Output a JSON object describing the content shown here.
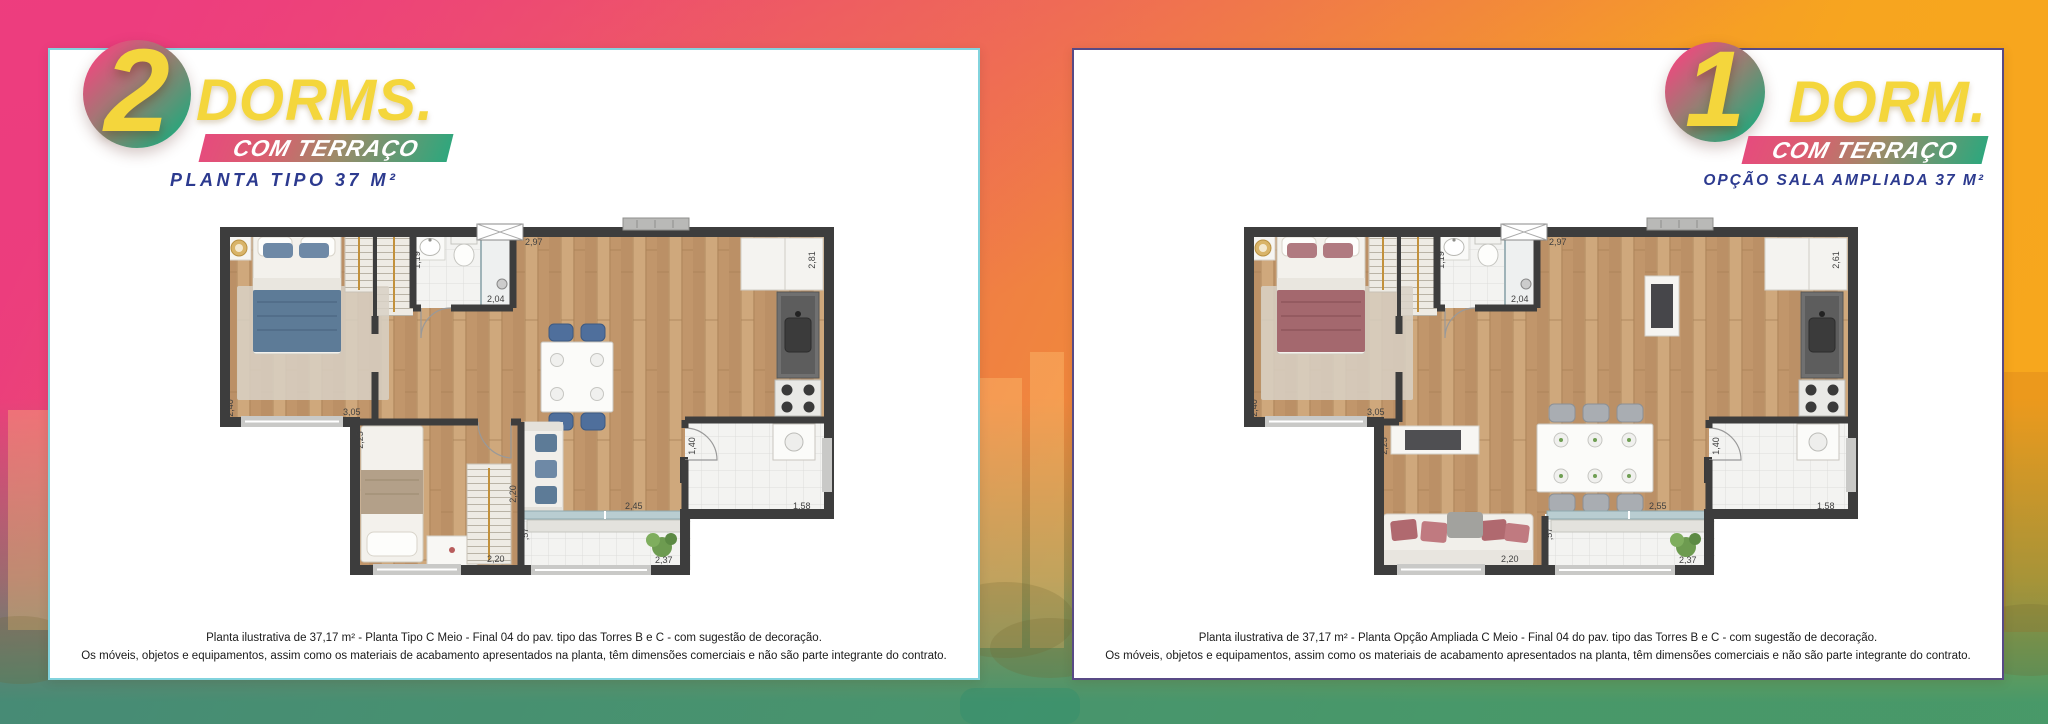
{
  "colors": {
    "accent_pink": "#ee3d7f",
    "accent_orange": "#f7a51f",
    "accent_green": "#2ea77d",
    "accent_yellow": "#f4d63c",
    "navy": "#2c3a8f",
    "card_border_left": "#82d3dd",
    "card_border_right": "#584a85"
  },
  "cards": {
    "left": {
      "badge": {
        "number": "2",
        "title": "DORMS.",
        "ribbon": "COM TERRAÇO",
        "subtitle": "PLANTA TIPO 37 M²"
      },
      "disclaimer_line1": "Planta ilustrativa de 37,17 m² - Planta Tipo C Meio - Final 04 do pav. tipo das Torres B e C - com sugestão de decoração.",
      "disclaimer_line2": "Os móveis, objetos e equipamentos, assim como os materiais de acabamento apresentados na planta, têm dimensões comerciais e não são parte integrante do contrato.",
      "dims": {
        "bedroom_width": "2,40",
        "bedroom_length": "3,05",
        "bath_width": "1,19",
        "bath_length": "2,04",
        "living_top": "2,97",
        "kitchen_right": "2,81",
        "bedroom2_depth": "2,25",
        "bedroom2_width": "2,20",
        "sofa_wall": "2,20",
        "terrace_depth": ",57",
        "living_bottom": "2,45",
        "terrace_width": "2,37",
        "service_depth": "1,40",
        "service_width": "1,58"
      }
    },
    "right": {
      "badge": {
        "number": "1",
        "title": "DORM.",
        "ribbon": "COM TERRAÇO",
        "subtitle": "OPÇÃO SALA AMPLIADA 37 M²"
      },
      "disclaimer_line1": "Planta ilustrativa de 37,17 m² - Planta Opção Ampliada C Meio - Final 04 do pav. tipo das Torres B e C - com sugestão de decoração.",
      "disclaimer_line2": "Os móveis, objetos e equipamentos, assim como os materiais de acabamento apresentados na planta, têm dimensões comerciais e não são parte integrante do contrato.",
      "dims": {
        "bedroom_width": "2,40",
        "bedroom_length": "3,05",
        "bath_width": "1,19",
        "bath_length": "2,04",
        "living_top": "2,97",
        "kitchen_right": "2,61",
        "sideboard_wall": "2,25",
        "sofa_width": "2,20",
        "terrace_depth": ",57",
        "living_bottom": "2,55",
        "terrace_width": "2,37",
        "service_depth": "1,40",
        "service_width": "1,58"
      }
    }
  }
}
